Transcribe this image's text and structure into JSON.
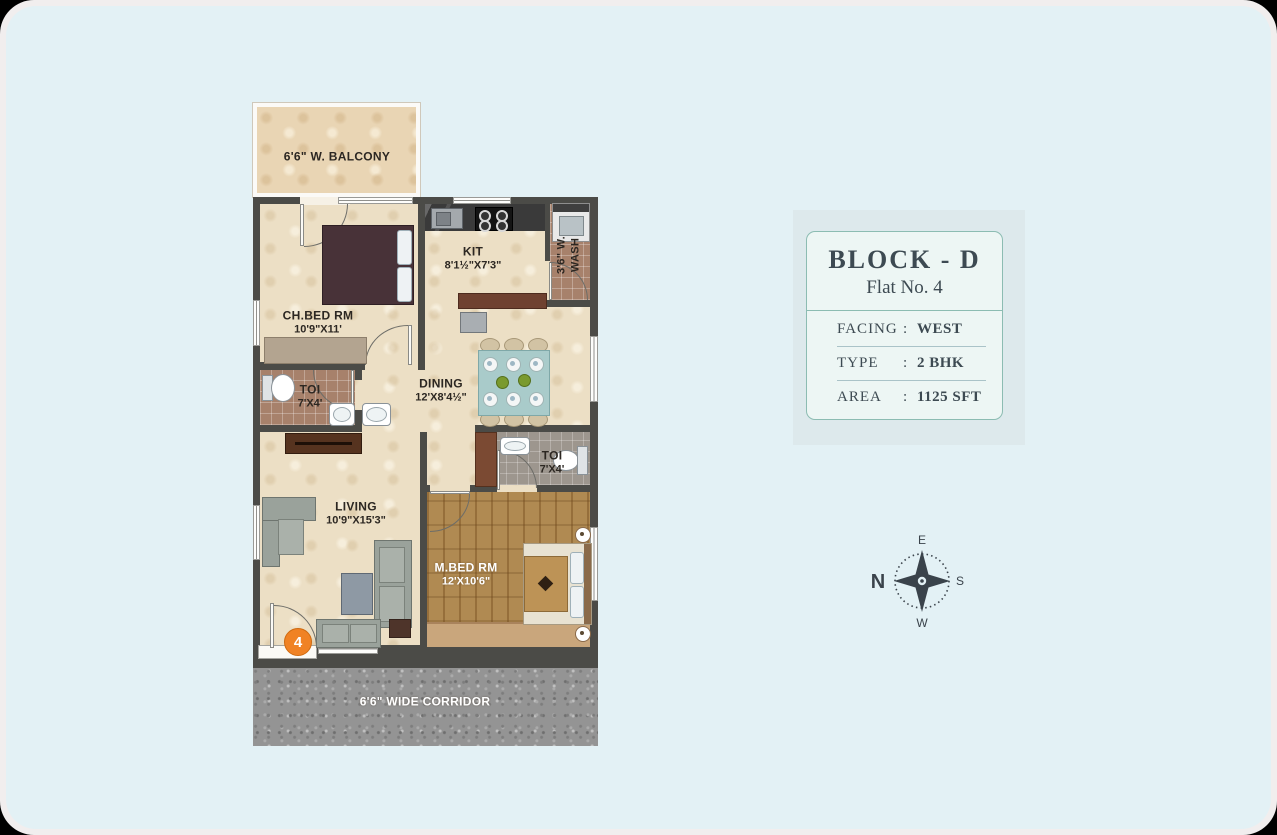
{
  "colors": {
    "page_bg": "#e3f1f5",
    "wall": "#4b4b47",
    "accent_orange": "#f08224",
    "card_border": "#8cbcb2",
    "ink": "#3d4a52"
  },
  "floor_plan": {
    "balcony": {
      "name": "6'6\" W. BALCONY"
    },
    "ch_bed": {
      "name": "CH.BED RM",
      "dims": "10'9\"X11'"
    },
    "kitchen": {
      "name": "KIT",
      "dims": "8'1½\"X7'3\""
    },
    "wash": {
      "line1": "3'6\" W.",
      "line2": "WASH"
    },
    "toilet1": {
      "name": "TOI",
      "dims": "7'X4'"
    },
    "dining": {
      "name": "DINING",
      "dims": "12'X8'4½\""
    },
    "toilet2": {
      "name": "TOI",
      "dims": "7'X4'"
    },
    "living": {
      "name": "LIVING",
      "dims": "10'9\"X15'3\""
    },
    "m_bed": {
      "name": "M.BED RM",
      "dims": "12'X10'6\""
    },
    "corridor": {
      "name": "6'6\" WIDE CORRIDOR"
    },
    "unit_number": "4"
  },
  "info_card": {
    "title": "BLOCK - D",
    "subtitle": "Flat No. 4",
    "rows": [
      {
        "label": "FACING",
        "colon": ":",
        "value": "WEST"
      },
      {
        "label": "TYPE",
        "colon": ":",
        "value": "2 BHK"
      },
      {
        "label": "AREA",
        "colon": ":",
        "value": "1125 SFT"
      }
    ]
  },
  "compass": {
    "n": "N",
    "e": "E",
    "s": "S",
    "w": "W"
  }
}
